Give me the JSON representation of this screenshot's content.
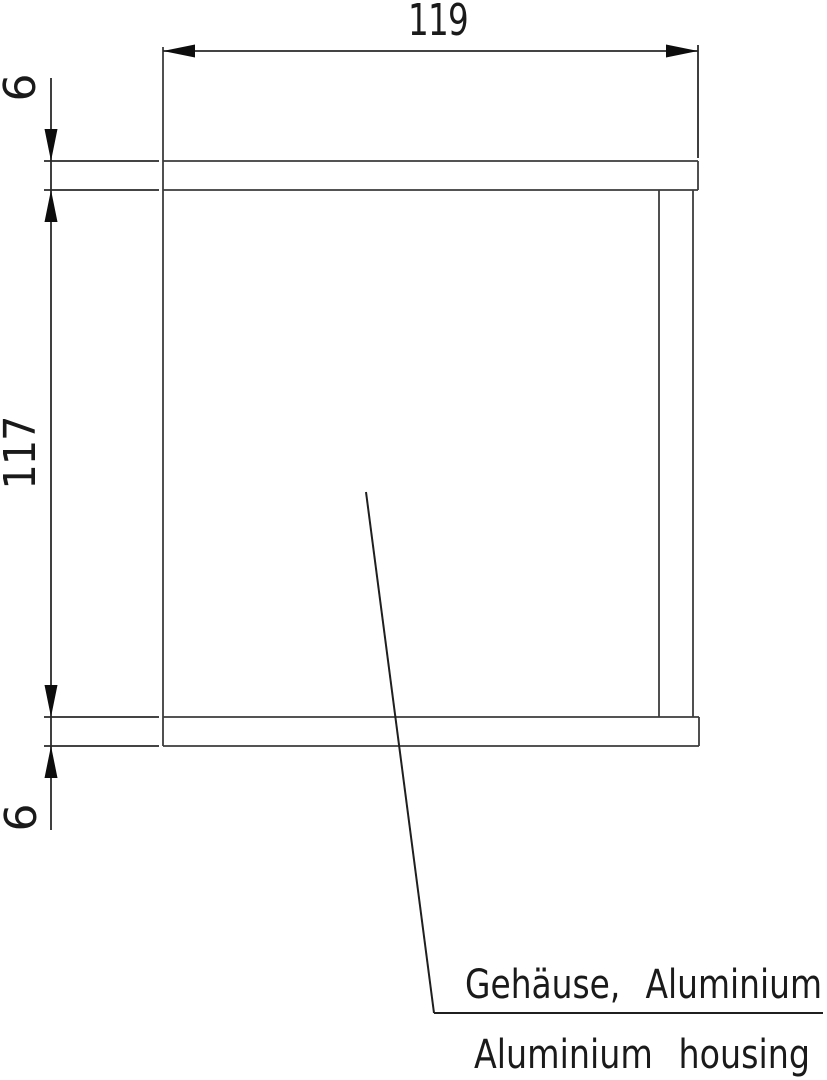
{
  "drawing": {
    "kind": "technical-cross-section",
    "part": {
      "label_de": "Gehäuse, Aluminium",
      "label_en": "Aluminium housing"
    },
    "dimensions": {
      "overall_width": "119",
      "top_wall_thickness": "6",
      "inner_height": "117",
      "bottom_wall_thickness": "6"
    },
    "colors": {
      "background": "#ffffff",
      "outline": "#3c3c3c",
      "dimension_line": "#2a2a2a",
      "arrow": "#0d0d0d",
      "text": "#1a1a1a"
    }
  }
}
